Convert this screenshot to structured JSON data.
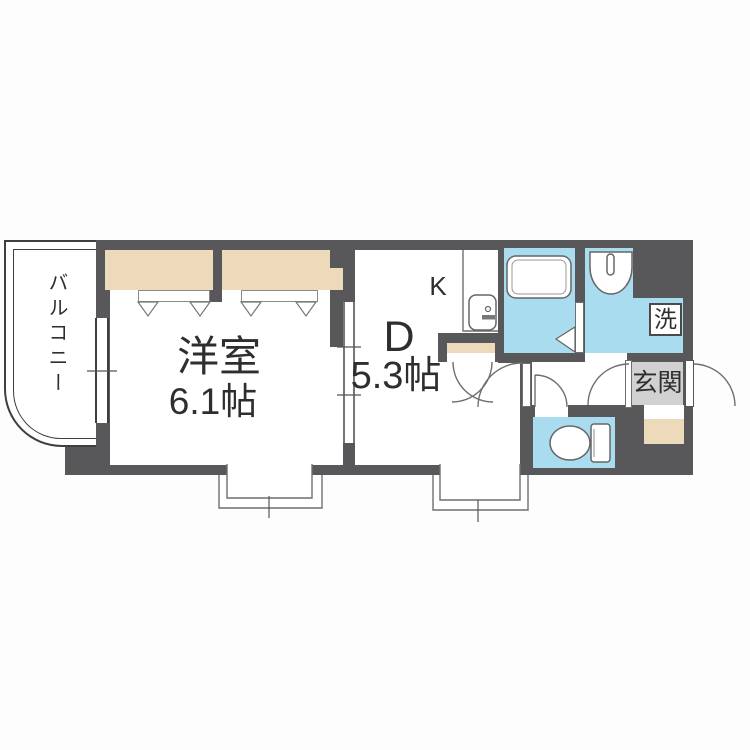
{
  "title": "apartment-floor-plan",
  "labels": {
    "balcony": "バルコニー",
    "western_room": "洋室",
    "western_room_size": "6.1帖",
    "dining": "D",
    "dining_size": "5.3帖",
    "kitchen": "K",
    "entrance": "玄関",
    "laundry": "洗"
  },
  "colors": {
    "wall": "#58585a",
    "water": "#a9dcee",
    "closet": "#ecdabb",
    "tile": "#d1d1d1",
    "line": "#6f6f6f",
    "ink": "#2e2e2e",
    "paper": "#fdfdfd"
  },
  "fixtures": [
    "bathtub",
    "washbasin",
    "toilet",
    "kitchen-sink",
    "bay-window",
    "entrance-door",
    "balcony-window"
  ]
}
